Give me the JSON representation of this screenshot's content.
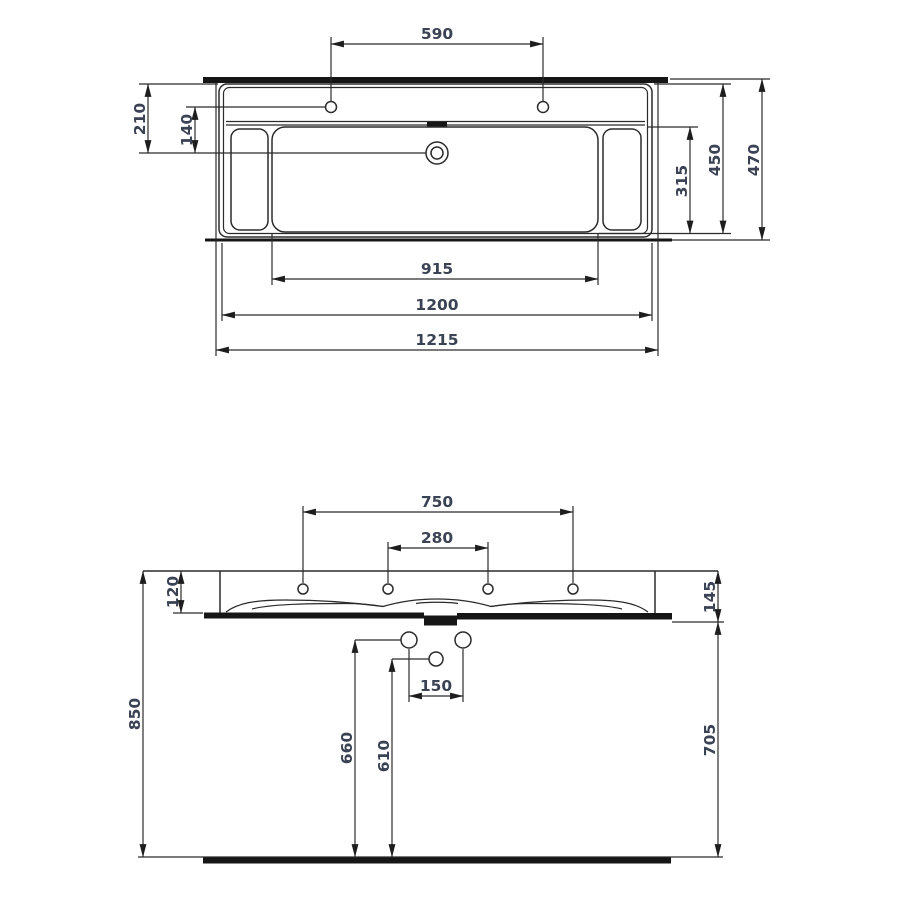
{
  "page": {
    "background": "#ffffff",
    "frame_color": "#e6e6e6"
  },
  "drawing": {
    "line_color": "#2b2b2b",
    "label_color": "#3a4254",
    "top_view": {
      "dims": {
        "faucet_hole_spacing": "590",
        "edge_to_drain": "210",
        "bowl_edge_to_drain": "140",
        "bowl_depth": "315",
        "rim_depth": "450",
        "overall_depth": "470",
        "bowl_width": "915",
        "rim_width": "1200",
        "overall_width": "1215"
      }
    },
    "front_view": {
      "dims": {
        "outer_hole_spacing": "750",
        "inner_hole_spacing": "280",
        "front_apron_height": "120",
        "overall_height": "145",
        "waste_spacing": "150",
        "left_waste_height": "660",
        "center_waste_height": "610",
        "rim_height_from_floor": "850",
        "underside_height_from_floor": "705"
      }
    }
  }
}
